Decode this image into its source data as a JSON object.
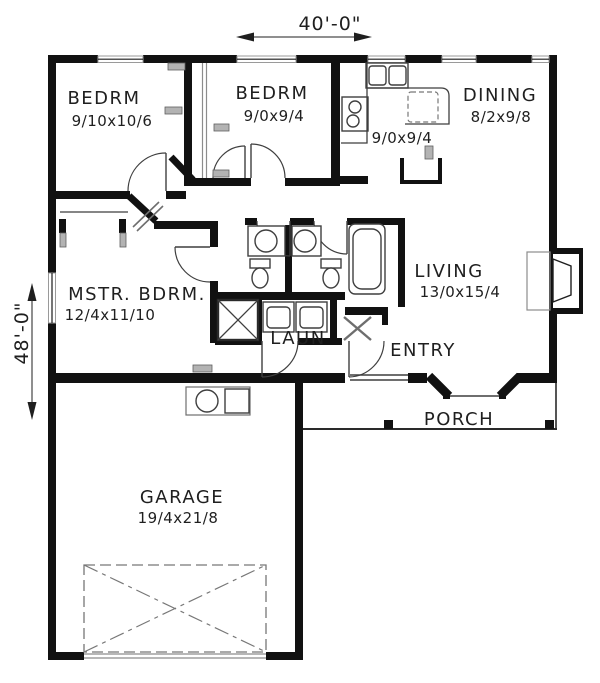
{
  "plan": {
    "type": "architectural-floor-plan",
    "dimensions": {
      "top": "40'-0\"",
      "left": "48'-0\""
    },
    "rooms": [
      {
        "id": "bedroom-1",
        "name": "BEDRM",
        "size": "9/10x10/6"
      },
      {
        "id": "bedroom-2",
        "name": "BEDRM",
        "size": "9/0x9/4"
      },
      {
        "id": "dining",
        "name": "DINING",
        "size": "8/2x9/8"
      },
      {
        "id": "kitchen-nook",
        "name": "",
        "size": "9/0x9/4"
      },
      {
        "id": "living",
        "name": "LIVING",
        "size": "13/0x15/4"
      },
      {
        "id": "master-bedroom",
        "name": "MSTR. BDRM.",
        "size": "12/4x11/10"
      },
      {
        "id": "laundry",
        "name": "LAUN",
        "size": ""
      },
      {
        "id": "entry",
        "name": "ENTRY",
        "size": ""
      },
      {
        "id": "porch",
        "name": "PORCH",
        "size": ""
      },
      {
        "id": "garage",
        "name": "GARAGE",
        "size": "19/4x21/8"
      }
    ],
    "fixtures": [
      "kitchen-sink",
      "range",
      "dishwasher",
      "pantry",
      "fireplace",
      "bathtub",
      "toilet",
      "vanity-sink",
      "shower",
      "washer",
      "dryer",
      "water-heater",
      "furnace"
    ]
  },
  "colors": {
    "wall": "#111111",
    "line": "#3f3f3f",
    "light_line": "#8c8c8c",
    "register_fill": "#b3b3b3",
    "text": "#1f1f1f",
    "dash": "#777777",
    "background": "#ffffff"
  }
}
